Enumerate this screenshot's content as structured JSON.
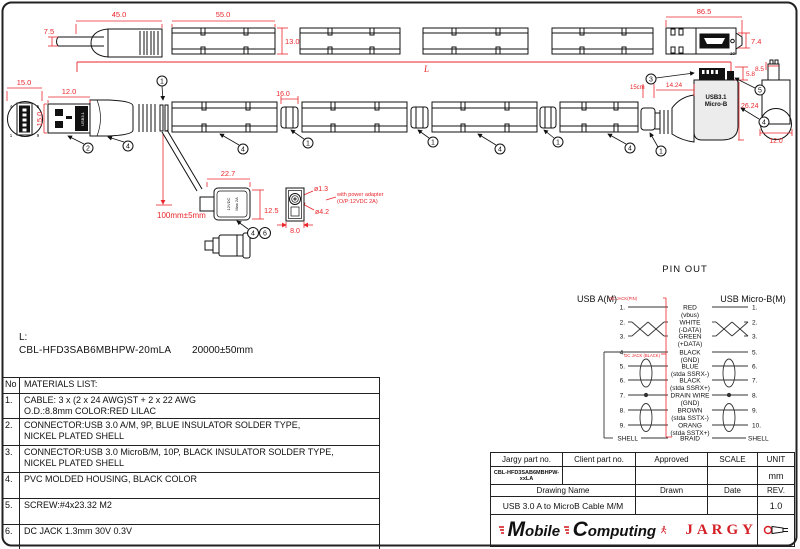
{
  "drawing": {
    "dims": {
      "d45": "45.0",
      "d7_5": "7.5",
      "d55": "55.0",
      "d13": "13.0",
      "d86_5": "86.5",
      "d7_4": "7.4",
      "d15_front": "15.0",
      "d12_side": "12.0",
      "d15_side": "15.0",
      "L": "L",
      "d16": "16.0",
      "d22_7": "22.7",
      "d12_5": "12.5",
      "d100mm": "100mm±5mm",
      "d1_3": "ø1.3",
      "d4_2": "ø4.2",
      "d8": "8.0",
      "power_note1": "with power adapter",
      "power_note2": "(O/P:12VDC 2A)",
      "d15cm": "15cm",
      "d14_24": "14.24",
      "d5_8": "5.8",
      "d26_24": "26.24",
      "d8_5": "8.5",
      "d12_right": "12.0"
    },
    "callouts": {
      "c1": "1",
      "c2": "2",
      "c3": "3",
      "c4": "4",
      "c5": "5",
      "c6": "6"
    },
    "labels": {
      "usb31_vertical": "USB3.1",
      "microb_line1": "USB3.1",
      "microb_line2": "Micro-B",
      "dc_line1": "12VDC",
      "dc_line2": "Max 2A",
      "pin10": "10",
      "front_pin_tl": "4",
      "front_pin_tr": "5",
      "front_pin_bl": "1",
      "front_pin_br": "9"
    }
  },
  "length_note": {
    "prefix": "L:",
    "part": "CBL-HFD3SAB6MBHPW-20mLA",
    "tolerance": "20000±50mm"
  },
  "pinout": {
    "title": "PIN OUT",
    "left_header": "USB A(M)",
    "right_header": "USB Micro-B(M)",
    "red_label_top": "DC JACK(PIN)",
    "red_label_mid": "DC JACK (BLACK)",
    "rows": [
      {
        "l": "1.",
        "c": "RED",
        "s": "(vbus)",
        "r": "1."
      },
      {
        "l": "2.",
        "c": "WHITE",
        "s": "(-DATA)",
        "r": "2."
      },
      {
        "l": "3.",
        "c": "GREEN",
        "s": "(+DATA)",
        "r": "3."
      },
      {
        "l": "4.",
        "c": "BLACK",
        "s": "(GND)",
        "r": "5."
      },
      {
        "l": "5.",
        "c": "BLUE",
        "s": "(stda SSRX-)",
        "r": "6."
      },
      {
        "l": "6.",
        "c": "BLACK",
        "s": "(stda SSRX+)",
        "r": "7."
      },
      {
        "l": "7.",
        "c": "DRAIN WIRE",
        "s": "(GND)",
        "r": "8."
      },
      {
        "l": "8.",
        "c": "BROWN",
        "s": "(stda SSTX-)",
        "r": "9."
      },
      {
        "l": "9.",
        "c": "ORANG",
        "s": "(stda SSTX+)",
        "r": "10."
      },
      {
        "l": "SHELL",
        "c": "BRAID",
        "s": "",
        "r": "SHELL"
      }
    ]
  },
  "materials": {
    "no_header": "No",
    "list_header": "MATERIALS LIST:",
    "rows": [
      {
        "no": "1.",
        "line1": "CABLE: 3 x (2 x 24 AWG)ST + 2 x 22 AWG",
        "line2": "O.D.:8.8mm COLOR:RED LILAC"
      },
      {
        "no": "2.",
        "line1": "CONNECTOR:USB 3.0 A/M, 9P, BLUE INSULATOR SOLDER TYPE,",
        "line2": "NICKEL PLATED SHELL"
      },
      {
        "no": "3.",
        "line1": "CONNECTOR:USB 3.0 MicroB/M, 10P, BLACK INSULATOR SOLDER TYPE,",
        "line2": "NICKEL PLATED SHELL"
      },
      {
        "no": "4.",
        "line1": "PVC MOLDED HOUSING, BLACK COLOR",
        "line2": ""
      },
      {
        "no": "5.",
        "line1": "SCREW:#4x23.32 M2",
        "line2": ""
      },
      {
        "no": "6.",
        "line1": "DC JACK 1.3mm 30V 0.3V",
        "line2": ""
      }
    ]
  },
  "title_block": {
    "jargy_label": "Jargy part no.",
    "client_label": "Client part no.",
    "approved_label": "Approved",
    "scale_label": "SCALE",
    "unit_label": "UNIT",
    "jargy_value": "CBL-HFD3SAB6MBHPW-xxLA",
    "unit_value": "mm",
    "drawing_name_label": "Drawing Name",
    "drawn_label": "Drawn",
    "date_label": "Date",
    "rev_label": "REV.",
    "drawing_name_value": "USB 3.0 A to MicroB Cable M/M",
    "rev_value": "1.0"
  },
  "branding": {
    "word1": "Mobile",
    "word2": "Computing",
    "jargy": "JARGY"
  },
  "colors": {
    "dim_red": "#e8262c",
    "line_black": "#111111"
  }
}
